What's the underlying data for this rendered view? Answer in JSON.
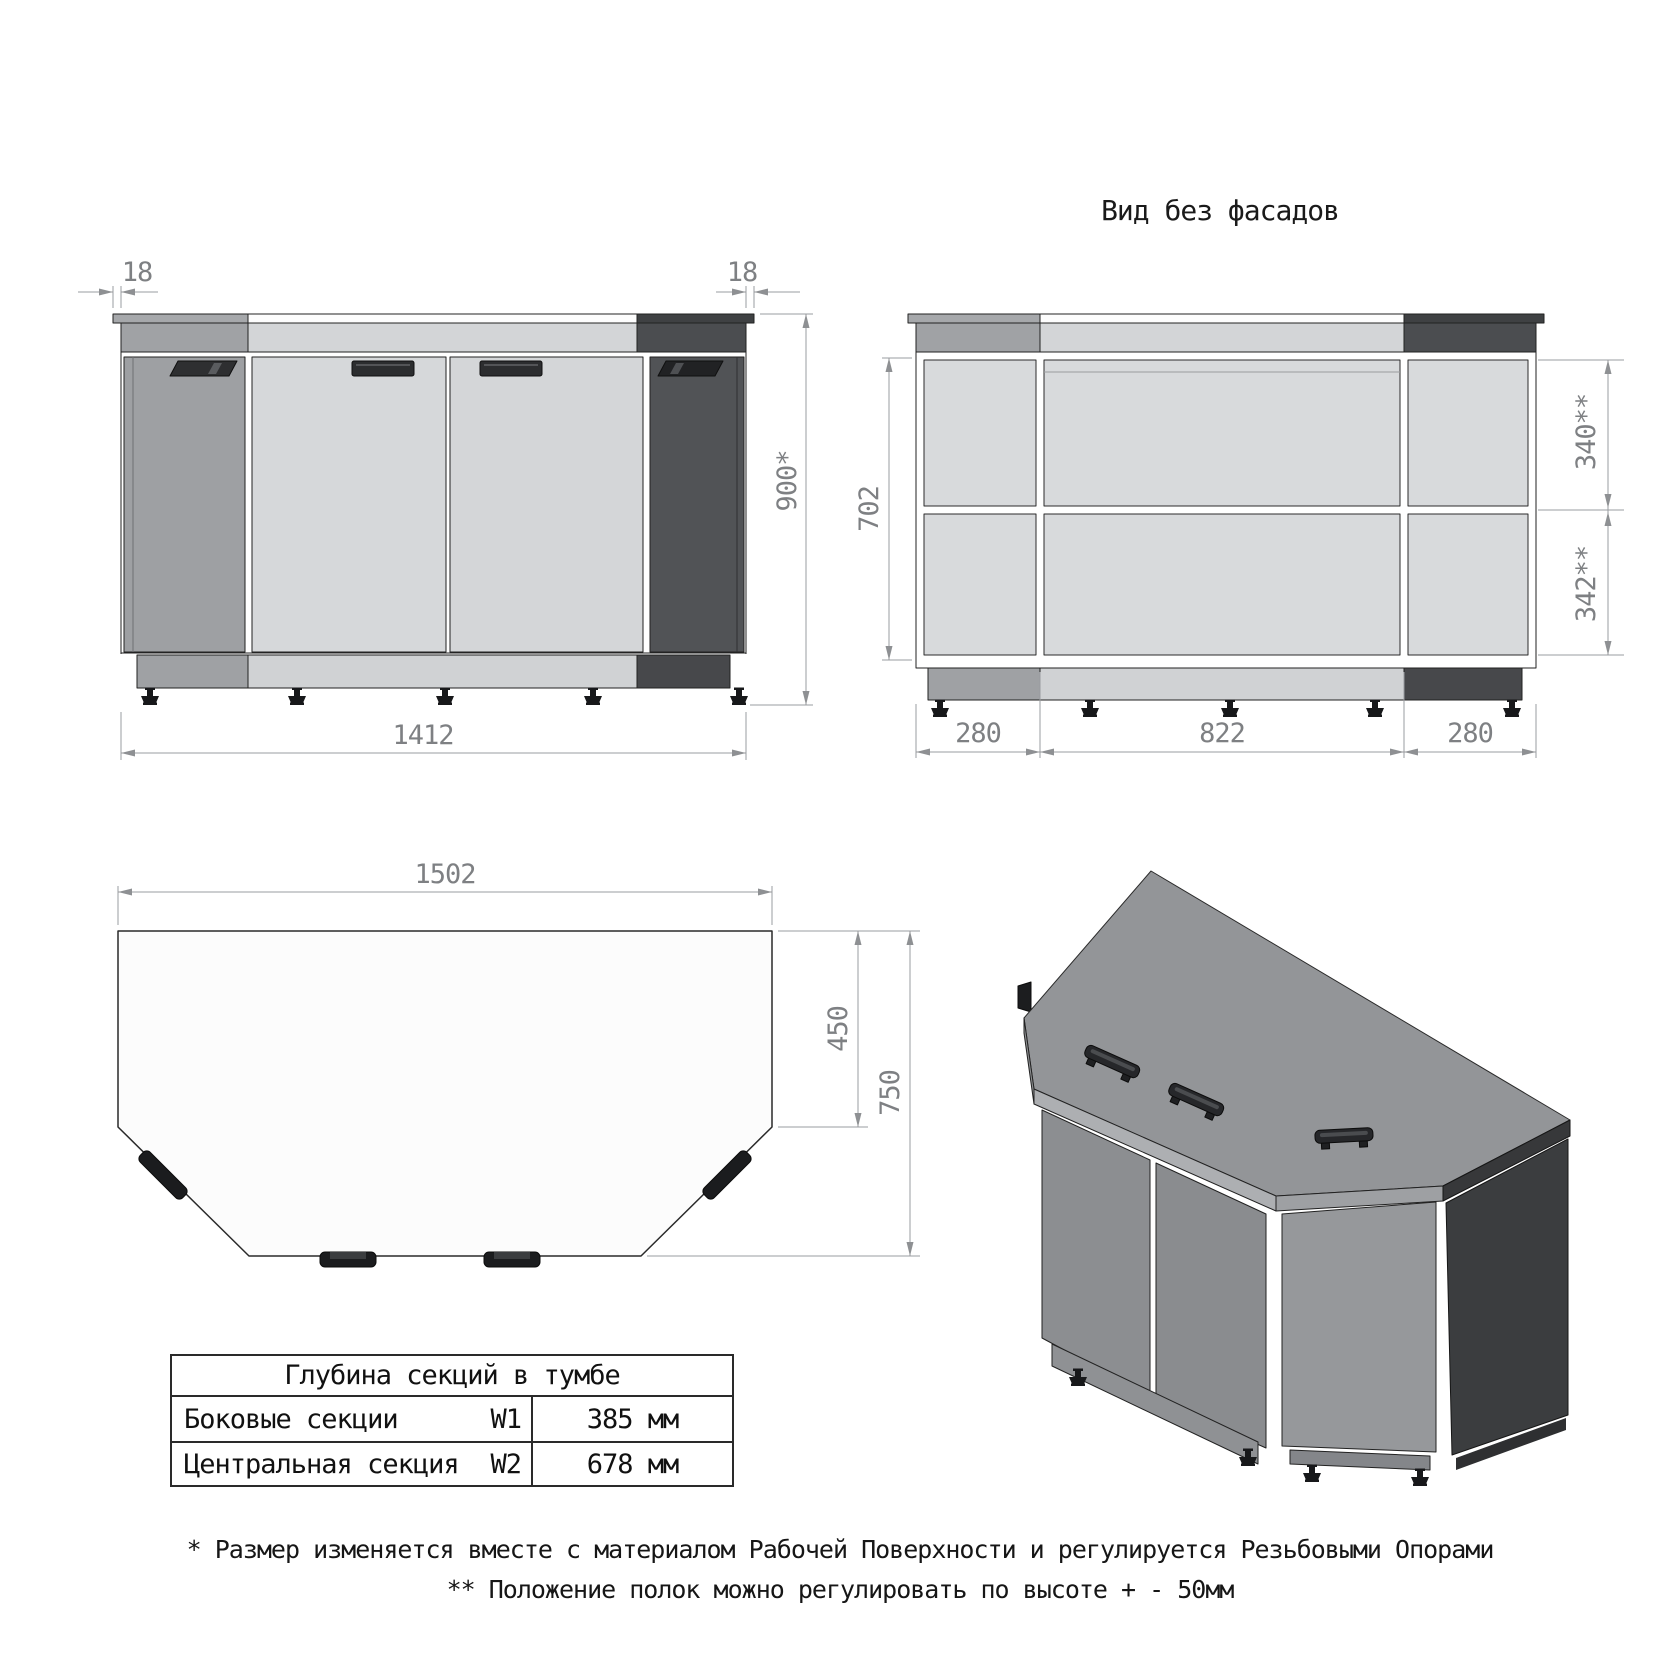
{
  "drawing": {
    "type": "furniture technical drawing",
    "subject": "corner cabinet (тумба)"
  },
  "no_facade_view": {
    "title": "Вид без фасадов"
  },
  "front_view": {
    "dims": {
      "overhang_left": "18",
      "overhang_right": "18",
      "height": "900*",
      "width": "1412"
    }
  },
  "no_facade_dims": {
    "inner_height": "702",
    "upper_shelf": "340**",
    "lower_shelf": "342**",
    "left_section": "280",
    "center_section": "822",
    "right_section": "280"
  },
  "plan_view": {
    "dims": {
      "width": "1502",
      "side_depth": "450",
      "total_depth": "750"
    }
  },
  "table": {
    "title": "Глубина секций в тумбе",
    "rows": [
      {
        "label": "Боковые секции",
        "code": "W1",
        "value": "385 мм"
      },
      {
        "label": "Центральная секция",
        "code": "W2",
        "value": "678 мм"
      }
    ]
  },
  "notes": [
    "* Размер изменяется вместе с материалом Рабочей Поверхности и регулируется Резьбовыми Опорами",
    "** Положение полок можно регулировать по высоте + - 50мм"
  ],
  "colors": {
    "side_section_gray": "#9EA0A3",
    "center_section_light": "#D5D7D9",
    "dark_section": "#515356",
    "interior_panel": "#D8DADC",
    "outline": "#222222",
    "dimension_gray": "#7E8083"
  }
}
